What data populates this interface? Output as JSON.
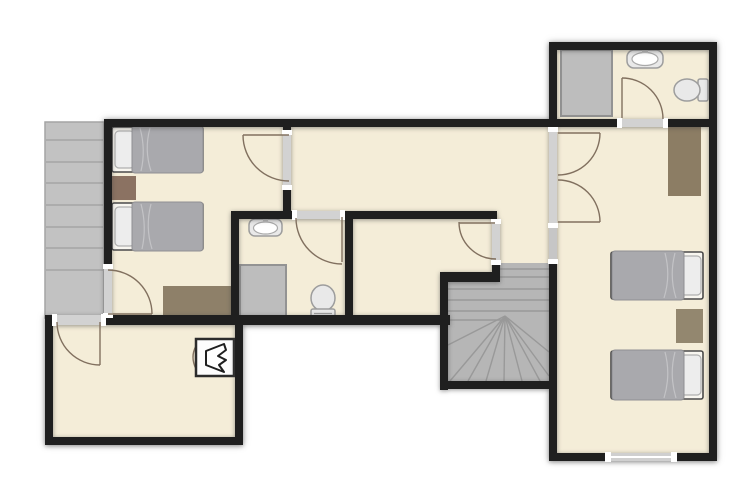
{
  "title": "apartment-upper-floor-plan",
  "colors": {
    "bg": "#ffffff",
    "wall": "#1f1f1f",
    "floor": "#f4edd8",
    "balcony": "#c2c2c2",
    "balcony_line": "#a4a4a4",
    "stairs": "#b6b6b6",
    "stairs_line": "#999999",
    "door_gap": "#d2d2d2",
    "door_arc": "#81705f",
    "wood_nightstand": "#8b7262",
    "wood_dresser": "#8e8069",
    "wood_wardrobe": "#8c7d64",
    "wood_nightstand2": "#93876f",
    "duvet": "#a9a9ad",
    "pillow": "#ededed",
    "fixture": "#e9e9e9",
    "fixture_line": "#9d9d9d",
    "shower": "#bdbdbd",
    "window": "#cfcfcf"
  },
  "floorplan": {
    "rooms": [
      {
        "name": "balcony-left",
        "items": [
          "deck-planks"
        ]
      },
      {
        "name": "bedroom-top-left",
        "items": [
          "single-bed",
          "single-bed",
          "nightstand",
          "dresser"
        ]
      },
      {
        "name": "hallway-top",
        "items": []
      },
      {
        "name": "bathroom-center",
        "items": [
          "sink",
          "shower",
          "toilet"
        ]
      },
      {
        "name": "storage-room-center",
        "items": []
      },
      {
        "name": "staircase-center",
        "items": [
          "winder-stairs"
        ]
      },
      {
        "name": "bathroom-top-right",
        "items": [
          "shower",
          "sink",
          "toilet"
        ]
      },
      {
        "name": "bedroom-right",
        "items": [
          "wardrobe",
          "single-bed",
          "nightstand",
          "single-bed"
        ]
      },
      {
        "name": "room-bottom-left",
        "items": [
          "fireplace"
        ]
      }
    ],
    "door_count": 8,
    "double_door_count": 1,
    "window_count": 1
  }
}
